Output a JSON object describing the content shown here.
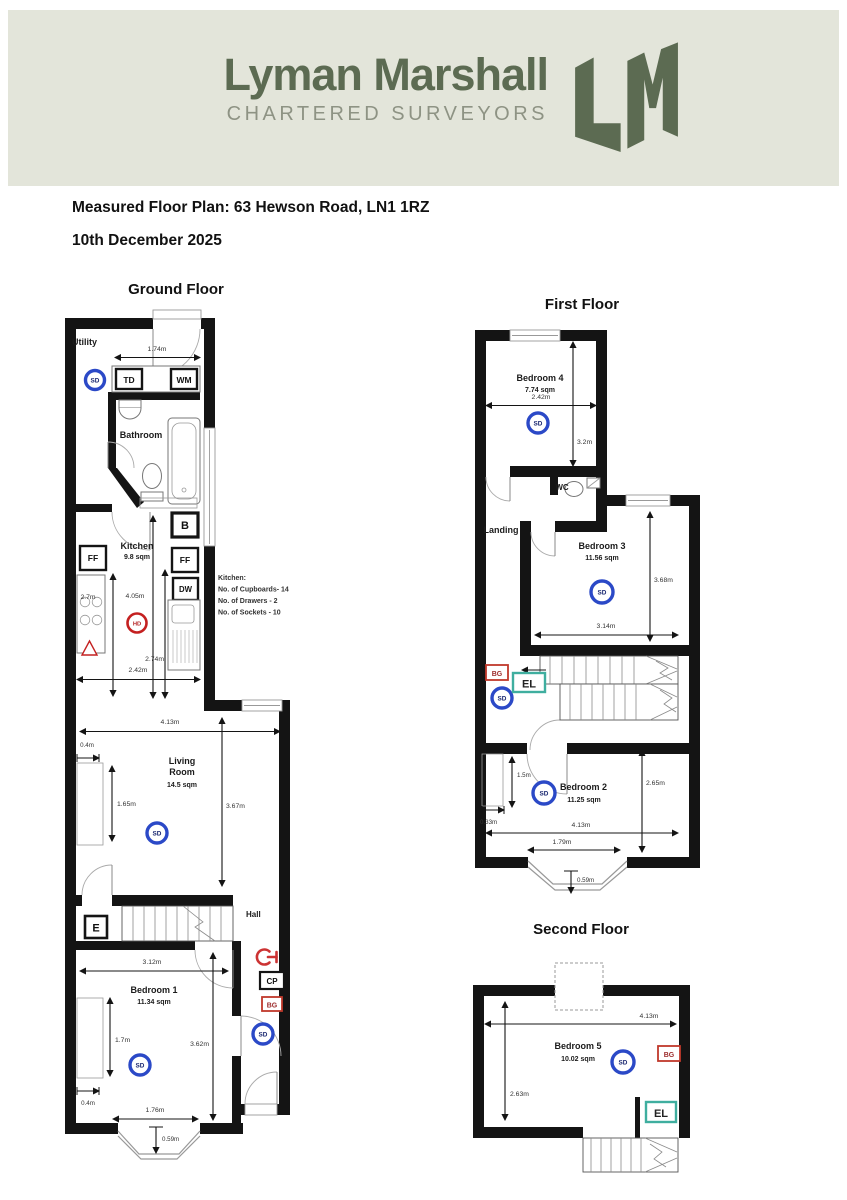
{
  "colors": {
    "header_bg": "#e3e5da",
    "brand": "#5c6b52",
    "tagline": "#8e9384",
    "sd_ring": "#2b49c7",
    "hd_ring": "#c42020",
    "bg_box": "#c0392b",
    "el_box": "#3fae9f",
    "stopcock": "#cc3333"
  },
  "header": {
    "brand": "Lyman Marshall",
    "tagline": "CHARTERED SURVEYORS"
  },
  "title": {
    "plan": "Measured Floor Plan: 63 Hewson Road, LN1 1RZ",
    "date": "10th December 2025"
  },
  "symbols": {
    "sd": "SD",
    "hd": "HD",
    "e": "E",
    "cp": "CP",
    "bg": "BG",
    "el": "EL",
    "td": "TD",
    "wm": "WM",
    "b": "B",
    "ff": "FF",
    "dw": "DW"
  },
  "ground": {
    "heading": "Ground Floor",
    "rooms": {
      "utility": "Utility",
      "bathroom": "Bathroom",
      "kitchen": "Kitchen",
      "kitchen_area": "9.8 sqm",
      "living1": "Living",
      "living2": "Room",
      "living_area": "14.5 sqm",
      "hall": "Hall",
      "bed1": "Bedroom 1",
      "bed1_area": "11.34 sqm"
    },
    "dims": {
      "utility_w": "1.74m",
      "k_left": "2.7m",
      "k_mid": "4.05m",
      "k_right": "2.74m",
      "k_w": "2.42m",
      "lr_w": "4.13m",
      "lr_nook": "0.4m",
      "lr_left": "1.65m",
      "lr_h": "3.67m",
      "b1_w": "3.12m",
      "b1_left": "1.7m",
      "b1_h": "3.62m",
      "b1_nook": "0.4m",
      "b1_bay_w": "1.76m",
      "b1_bay_d": "0.59m"
    },
    "note": [
      "Kitchen:",
      "No. of Cupboards- 14",
      "No. of Drawers - 2",
      "No. of Sockets - 10"
    ]
  },
  "first": {
    "heading": "First Floor",
    "rooms": {
      "bed4": "Bedroom 4",
      "bed4_area": "7.74 sqm",
      "wc": "WC",
      "landing": "Landing",
      "bed3": "Bedroom 3",
      "bed3_area": "11.56 sqm",
      "bed2": "Bedroom 2",
      "bed2_area": "11.25 sqm"
    },
    "dims": {
      "b4_w": "2.42m",
      "b4_h": "3.2m",
      "b3_h": "3.68m",
      "b3_w": "3.14m",
      "b2_nook_h": "1.5m",
      "b2_nook_w": "0.33m",
      "b2_w": "4.13m",
      "b2_h": "2.65m",
      "b2_bay_w": "1.79m",
      "b2_bay_d": "0.59m"
    }
  },
  "second": {
    "heading": "Second Floor",
    "rooms": {
      "bed5": "Bedroom 5",
      "bed5_area": "10.02 sqm"
    },
    "dims": {
      "w": "4.13m",
      "h": "2.63m"
    }
  }
}
